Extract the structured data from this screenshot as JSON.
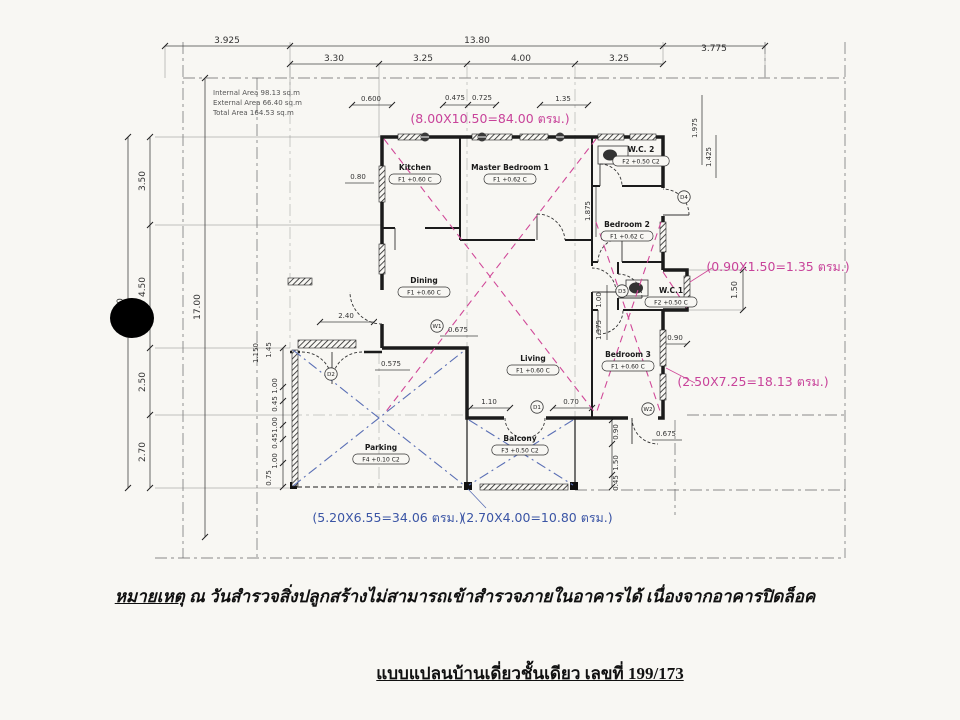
{
  "page": {
    "note_prefix": "หมายเหตุ",
    "note_body": " ณ วันสำรวจสิ่งปลูกสร้างไม่สามารถเข้าสำรวจภายในอาคารได้ เนื่องจากอาคารปิดล็อค",
    "title": "แบบแปลนบ้านเดี่ยวชั้นเดียว เลขที่ 199/173"
  },
  "area_table": {
    "lines": [
      "Internal Area 98.13 sq.m",
      "External Area 66.40 sq.m",
      "Total    Area 164.53 sq.m"
    ]
  },
  "rooms": [
    {
      "name": "Kitchen",
      "tag": "F1 +0.60 C",
      "x": 415,
      "y": 170
    },
    {
      "name": "Master Bedroom 1",
      "tag": "F1 +0.62 C",
      "x": 510,
      "y": 170
    },
    {
      "name": "W.C. 2",
      "tag": "F2 +0.50 C2",
      "x": 641,
      "y": 152
    },
    {
      "name": "Bedroom 2",
      "tag": "F1 +0.62 C",
      "x": 627,
      "y": 227
    },
    {
      "name": "Dining",
      "tag": "F1 +0.60 C",
      "x": 424,
      "y": 283
    },
    {
      "name": "Living",
      "tag": "F1 +0.60 C",
      "x": 533,
      "y": 361
    },
    {
      "name": "W.C.1",
      "tag": "F2 +0.50 C",
      "x": 671,
      "y": 293
    },
    {
      "name": "Bedroom 3",
      "tag": "F1 +0.60 C",
      "x": 628,
      "y": 357
    },
    {
      "name": "Parking",
      "tag": "F4 +0.10 C2",
      "x": 381,
      "y": 450
    },
    {
      "name": "Balcony",
      "tag": "F3 +0.50 C2",
      "x": 520,
      "y": 441
    }
  ],
  "annotations": {
    "pink_color": "#c8439a",
    "blue_color": "#3b55a5",
    "pink": [
      {
        "text": "(8.00X10.50=84.00 ตรม.)",
        "x": 490,
        "y": 123
      },
      {
        "text": "(0.90X1.50=1.35 ตรม.)",
        "x": 778,
        "y": 271
      },
      {
        "text": "(2.50X7.25=18.13 ตรม.)",
        "x": 753,
        "y": 386
      }
    ],
    "blue": [
      {
        "text": "(5.20X6.55=34.06 ตรม.)",
        "x": 388,
        "y": 522
      },
      {
        "text": "(2.70X4.00=10.80 ตรม.)",
        "x": 537,
        "y": 522
      }
    ]
  },
  "dims": [
    {
      "t": "3.925",
      "x": 227,
      "y": 43,
      "s": 9
    },
    {
      "t": "13.80",
      "x": 477,
      "y": 43,
      "s": 9
    },
    {
      "t": "3.775",
      "x": 714,
      "y": 51,
      "s": 9
    },
    {
      "t": "3.30",
      "x": 334,
      "y": 61,
      "s": 9
    },
    {
      "t": "3.25",
      "x": 423,
      "y": 61,
      "s": 9
    },
    {
      "t": "4.00",
      "x": 521,
      "y": 61,
      "s": 9
    },
    {
      "t": "3.25",
      "x": 619,
      "y": 61,
      "s": 9
    },
    {
      "t": "3.50",
      "x": 145,
      "y": 181,
      "r": -90,
      "s": 9
    },
    {
      "t": "4.50",
      "x": 145,
      "y": 287,
      "r": -90,
      "s": 9
    },
    {
      "t": "2.50",
      "x": 145,
      "y": 382,
      "r": -90,
      "s": 9
    },
    {
      "t": "2.70",
      "x": 145,
      "y": 452,
      "r": -90,
      "s": 9
    },
    {
      "t": "13.20",
      "x": 123,
      "y": 311,
      "r": -90,
      "s": 9
    },
    {
      "t": "17.00",
      "x": 200,
      "y": 307,
      "r": -90,
      "s": 9
    },
    {
      "t": "1.50",
      "x": 737,
      "y": 290,
      "r": -90,
      "s": 8
    },
    {
      "t": "0.90",
      "x": 675,
      "y": 340
    },
    {
      "t": "1.975",
      "x": 697,
      "y": 128,
      "r": -90
    },
    {
      "t": "1.425",
      "x": 711,
      "y": 157,
      "r": -90
    },
    {
      "t": "0.600",
      "x": 371,
      "y": 101
    },
    {
      "t": "0.475",
      "x": 455,
      "y": 100
    },
    {
      "t": "0.725",
      "x": 482,
      "y": 100
    },
    {
      "t": "1.35",
      "x": 563,
      "y": 101
    },
    {
      "t": "0.80",
      "x": 358,
      "y": 179
    },
    {
      "t": "2.40",
      "x": 346,
      "y": 318
    },
    {
      "t": "0.675",
      "x": 458,
      "y": 332
    },
    {
      "t": "0.575",
      "x": 391,
      "y": 366
    },
    {
      "t": "1.10",
      "x": 489,
      "y": 404
    },
    {
      "t": "0.70",
      "x": 571,
      "y": 404
    },
    {
      "t": "0.675",
      "x": 666,
      "y": 436
    },
    {
      "t": "0.90",
      "x": 618,
      "y": 432,
      "r": -90
    },
    {
      "t": "1.50",
      "x": 618,
      "y": 463,
      "r": -90
    },
    {
      "t": "0.45",
      "x": 618,
      "y": 483,
      "r": -90
    },
    {
      "t": "1.875",
      "x": 590,
      "y": 211,
      "r": -90
    },
    {
      "t": "1.00",
      "x": 601,
      "y": 300,
      "r": -90
    },
    {
      "t": "1.375",
      "x": 601,
      "y": 330,
      "r": -90
    },
    {
      "t": "1.45",
      "x": 271,
      "y": 350,
      "r": -90
    },
    {
      "t": "1.150",
      "x": 258,
      "y": 353,
      "r": -90
    },
    {
      "t": "1.00",
      "x": 277,
      "y": 386,
      "r": -90
    },
    {
      "t": "0.45",
      "x": 277,
      "y": 404,
      "r": -90
    },
    {
      "t": "1.00",
      "x": 277,
      "y": 425,
      "r": -90
    },
    {
      "t": "0.45",
      "x": 277,
      "y": 441,
      "r": -90
    },
    {
      "t": "1.00",
      "x": 277,
      "y": 461,
      "r": -90
    },
    {
      "t": "0.75",
      "x": 271,
      "y": 478,
      "r": -90
    }
  ],
  "bubbles": [
    {
      "t": "D1",
      "x": 537,
      "y": 407
    },
    {
      "t": "D2",
      "x": 331,
      "y": 374
    },
    {
      "t": "D3",
      "x": 622,
      "y": 291
    },
    {
      "t": "D4",
      "x": 684,
      "y": 197
    },
    {
      "t": "W1",
      "x": 437,
      "y": 326
    },
    {
      "t": "W2",
      "x": 648,
      "y": 409
    }
  ]
}
